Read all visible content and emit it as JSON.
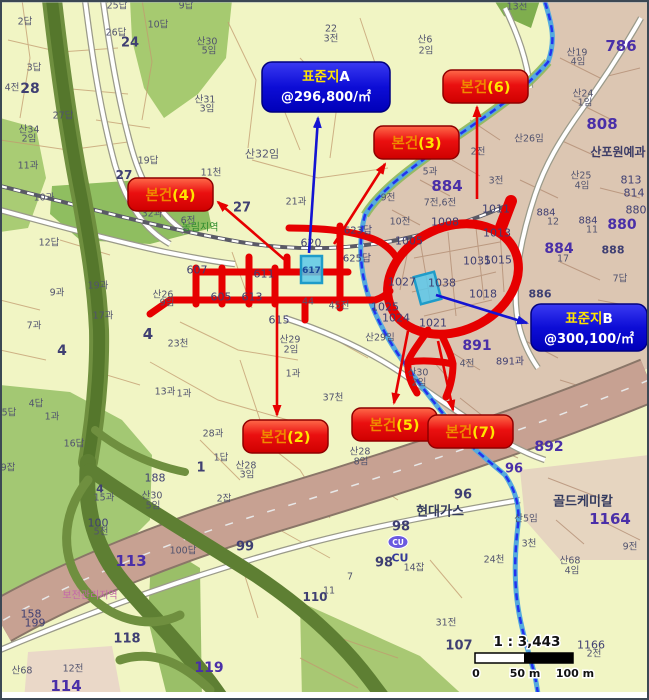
{
  "colors": {
    "accent_red": "#e60000",
    "accent_blue": "#1414d2",
    "cyan_marker": "#49c2ea",
    "map_bg": "#f1f5c4",
    "urban_fill": "#dcc6b2",
    "road_pink": "#c7a192",
    "highway_green": "#5e7f33"
  },
  "map": {
    "labels": [
      {
        "t": "2답",
        "x": 25,
        "y": 22
      },
      {
        "t": "28",
        "x": 30,
        "y": 89,
        "s": 14,
        "b": 1,
        "c": "#3f3f72"
      },
      {
        "t": "4전",
        "x": 12,
        "y": 88
      },
      {
        "t": "3답",
        "x": 34,
        "y": 68
      },
      {
        "t": "27답",
        "x": 63,
        "y": 116
      },
      {
        "t": "산34",
        "x": 29,
        "y": 130
      },
      {
        "t": "2임",
        "x": 29,
        "y": 139
      },
      {
        "t": "11과",
        "x": 28,
        "y": 166
      },
      {
        "t": "25답",
        "x": 117,
        "y": 6
      },
      {
        "t": "26답",
        "x": 116,
        "y": 33
      },
      {
        "t": "24",
        "x": 130,
        "y": 43,
        "s": 13,
        "b": 1,
        "c": "#3f3f72"
      },
      {
        "t": "10답",
        "x": 158,
        "y": 25
      },
      {
        "t": "9답",
        "x": 186,
        "y": 6
      },
      {
        "t": "산30",
        "x": 207,
        "y": 42
      },
      {
        "t": "5임",
        "x": 209,
        "y": 51
      },
      {
        "t": "산31",
        "x": 205,
        "y": 100
      },
      {
        "t": "3임",
        "x": 207,
        "y": 109
      },
      {
        "t": "19답",
        "x": 148,
        "y": 161
      },
      {
        "t": "11천",
        "x": 211,
        "y": 173
      },
      {
        "t": "27",
        "x": 124,
        "y": 175,
        "s": 12,
        "b": 1,
        "c": "#3f3f72"
      },
      {
        "t": "22",
        "x": 331,
        "y": 29
      },
      {
        "t": "3전",
        "x": 331,
        "y": 39
      },
      {
        "t": "산6",
        "x": 425,
        "y": 40
      },
      {
        "t": "2임",
        "x": 426,
        "y": 51
      },
      {
        "t": "13전",
        "x": 517,
        "y": 7
      },
      {
        "t": "산19",
        "x": 577,
        "y": 53
      },
      {
        "t": "4임",
        "x": 578,
        "y": 62
      },
      {
        "t": "786",
        "x": 621,
        "y": 46,
        "s": 15,
        "b": 1,
        "c": "#4a2fa8"
      },
      {
        "t": "산24",
        "x": 583,
        "y": 94
      },
      {
        "t": "1임",
        "x": 585,
        "y": 103
      },
      {
        "t": "808",
        "x": 602,
        "y": 124,
        "s": 15,
        "b": 1,
        "c": "#4a2fa8"
      },
      {
        "t": "산포원예과",
        "x": 618,
        "y": 152,
        "s": 12,
        "b": 1,
        "c": "#3c3c66"
      },
      {
        "t": "산26임",
        "x": 529,
        "y": 139
      },
      {
        "t": "2전",
        "x": 478,
        "y": 152
      },
      {
        "t": "3전",
        "x": 496,
        "y": 181
      },
      {
        "t": "산25",
        "x": 581,
        "y": 176
      },
      {
        "t": "4임",
        "x": 582,
        "y": 186
      },
      {
        "t": "813",
        "x": 631,
        "y": 180,
        "s": 11,
        "c": "#3f3f72"
      },
      {
        "t": "814",
        "x": 634,
        "y": 193,
        "s": 11,
        "c": "#3f3f72"
      },
      {
        "t": "880",
        "x": 636,
        "y": 210,
        "s": 11,
        "c": "#3f3f72"
      },
      {
        "t": "880",
        "x": 622,
        "y": 225,
        "s": 14,
        "b": 1,
        "c": "#4a2fa8"
      },
      {
        "t": "884",
        "x": 546,
        "y": 213,
        "s": 10,
        "c": "#3f3f72"
      },
      {
        "t": "12",
        "x": 553,
        "y": 222
      },
      {
        "t": "884",
        "x": 588,
        "y": 221,
        "s": 10,
        "c": "#3f3f72"
      },
      {
        "t": "11",
        "x": 592,
        "y": 230
      },
      {
        "t": "884",
        "x": 559,
        "y": 249,
        "s": 14,
        "b": 1,
        "c": "#4a2fa8"
      },
      {
        "t": "17",
        "x": 563,
        "y": 259
      },
      {
        "t": "888",
        "x": 613,
        "y": 250,
        "s": 11,
        "b": 1,
        "c": "#3f3f72"
      },
      {
        "t": "886",
        "x": 540,
        "y": 294,
        "s": 11,
        "b": 1,
        "c": "#3f3f72"
      },
      {
        "t": "7답",
        "x": 620,
        "y": 279
      },
      {
        "t": "884",
        "x": 447,
        "y": 186,
        "s": 15,
        "b": 1,
        "c": "#4a2fa8"
      },
      {
        "t": "5과",
        "x": 430,
        "y": 172
      },
      {
        "t": "4임",
        "x": 404,
        "y": 156
      },
      {
        "t": "9전",
        "x": 388,
        "y": 198
      },
      {
        "t": "7전,6전",
        "x": 440,
        "y": 203
      },
      {
        "t": "10전",
        "x": 400,
        "y": 222
      },
      {
        "t": "1008",
        "x": 445,
        "y": 222,
        "s": 11,
        "c": "#3f3f72"
      },
      {
        "t": "1011",
        "x": 496,
        "y": 209,
        "s": 11,
        "c": "#3f3f72"
      },
      {
        "t": "1005",
        "x": 409,
        "y": 241,
        "s": 11,
        "c": "#3f3f72"
      },
      {
        "t": "1013",
        "x": 497,
        "y": 233,
        "s": 11,
        "c": "#3f3f72"
      },
      {
        "t": "1035",
        "x": 477,
        "y": 261,
        "s": 11,
        "c": "#3f3f72"
      },
      {
        "t": "1015",
        "x": 498,
        "y": 260,
        "s": 11,
        "c": "#3f3f72"
      },
      {
        "t": "1027",
        "x": 402,
        "y": 282,
        "s": 11,
        "c": "#3f3f72"
      },
      {
        "t": "1038",
        "x": 442,
        "y": 283,
        "s": 11,
        "c": "#3f3f72"
      },
      {
        "t": "1018",
        "x": 483,
        "y": 294,
        "s": 11,
        "c": "#3f3f72"
      },
      {
        "t": "1025",
        "x": 385,
        "y": 307,
        "s": 11,
        "c": "#3f3f72"
      },
      {
        "t": "1024",
        "x": 396,
        "y": 318,
        "s": 11,
        "c": "#3f3f72"
      },
      {
        "t": "1021",
        "x": 433,
        "y": 323,
        "s": 11,
        "c": "#3f3f72"
      },
      {
        "t": "891",
        "x": 477,
        "y": 346,
        "s": 14,
        "b": 1,
        "c": "#4a2fa8"
      },
      {
        "t": "891과",
        "x": 510,
        "y": 362,
        "s": 10,
        "c": "#3f3f72"
      },
      {
        "t": "4전",
        "x": 467,
        "y": 364
      },
      {
        "t": "산30",
        "x": 418,
        "y": 373
      },
      {
        "t": "2임",
        "x": 419,
        "y": 383
      },
      {
        "t": "산29임",
        "x": 380,
        "y": 338
      },
      {
        "t": "산29",
        "x": 290,
        "y": 340
      },
      {
        "t": "2임",
        "x": 291,
        "y": 350
      },
      {
        "t": "1과",
        "x": 293,
        "y": 374
      },
      {
        "t": "37천",
        "x": 333,
        "y": 398
      },
      {
        "t": "산28",
        "x": 360,
        "y": 452
      },
      {
        "t": "8임",
        "x": 361,
        "y": 462
      },
      {
        "t": "산28",
        "x": 246,
        "y": 466
      },
      {
        "t": "3임",
        "x": 247,
        "y": 475
      },
      {
        "t": "620",
        "x": 311,
        "y": 243,
        "s": 11,
        "c": "#3f3f72"
      },
      {
        "t": "623답",
        "x": 358,
        "y": 231,
        "s": 10,
        "c": "#3f3f72"
      },
      {
        "t": "625답",
        "x": 357,
        "y": 259,
        "s": 10,
        "c": "#3f3f72"
      },
      {
        "t": "607",
        "x": 197,
        "y": 270,
        "s": 11,
        "c": "#3f3f72"
      },
      {
        "t": "611",
        "x": 264,
        "y": 274,
        "s": 11,
        "c": "#3f3f72"
      },
      {
        "t": "605",
        "x": 221,
        "y": 297,
        "s": 11,
        "c": "#3f3f72"
      },
      {
        "t": "613",
        "x": 252,
        "y": 297,
        "s": 11,
        "c": "#3f3f72"
      },
      {
        "t": "44",
        "x": 308,
        "y": 302
      },
      {
        "t": "45전",
        "x": 339,
        "y": 306
      },
      {
        "t": "615",
        "x": 279,
        "y": 320,
        "s": 11,
        "c": "#3f3f72"
      },
      {
        "t": "21과",
        "x": 296,
        "y": 202
      },
      {
        "t": "32과",
        "x": 152,
        "y": 214
      },
      {
        "t": "6전",
        "x": 188,
        "y": 221
      },
      {
        "t": "농림지역",
        "x": 200,
        "y": 228,
        "c": "#2e8b2e",
        "s": 10
      },
      {
        "t": "27",
        "x": 242,
        "y": 208,
        "s": 13,
        "b": 1,
        "c": "#3f3f72"
      },
      {
        "t": "산32임",
        "x": 262,
        "y": 154,
        "s": 11,
        "c": "#565873"
      },
      {
        "t": "10과",
        "x": 44,
        "y": 198
      },
      {
        "t": "12답",
        "x": 49,
        "y": 243
      },
      {
        "t": "9과",
        "x": 57,
        "y": 293
      },
      {
        "t": "7과",
        "x": 34,
        "y": 326
      },
      {
        "t": "4",
        "x": 148,
        "y": 334,
        "s": 15,
        "b": 1,
        "c": "#3f3f72"
      },
      {
        "t": "4",
        "x": 62,
        "y": 351,
        "s": 14,
        "b": 1,
        "c": "#3f3f72"
      },
      {
        "t": "19과",
        "x": 98,
        "y": 286
      },
      {
        "t": "17과",
        "x": 103,
        "y": 316
      },
      {
        "t": "산26",
        "x": 163,
        "y": 295
      },
      {
        "t": "9임",
        "x": 167,
        "y": 303
      },
      {
        "t": "23천",
        "x": 178,
        "y": 344
      },
      {
        "t": "4답",
        "x": 36,
        "y": 404
      },
      {
        "t": "5답",
        "x": 9,
        "y": 413
      },
      {
        "t": "1과",
        "x": 52,
        "y": 417
      },
      {
        "t": "9잡",
        "x": 8,
        "y": 468
      },
      {
        "t": "16답",
        "x": 74,
        "y": 444
      },
      {
        "t": "13과",
        "x": 165,
        "y": 392
      },
      {
        "t": "1과",
        "x": 184,
        "y": 394
      },
      {
        "t": "28과",
        "x": 213,
        "y": 434
      },
      {
        "t": "1답",
        "x": 221,
        "y": 458
      },
      {
        "t": "1",
        "x": 201,
        "y": 468,
        "s": 13,
        "b": 1,
        "c": "#3f3f72"
      },
      {
        "t": "2잡",
        "x": 224,
        "y": 499
      },
      {
        "t": "188",
        "x": 155,
        "y": 478,
        "s": 11,
        "c": "#3f3f72"
      },
      {
        "t": "산30",
        "x": 152,
        "y": 496
      },
      {
        "t": "5임",
        "x": 153,
        "y": 506
      },
      {
        "t": "4",
        "x": 100,
        "y": 489,
        "s": 11,
        "b": 1,
        "c": "#3f3f72"
      },
      {
        "t": "15과",
        "x": 104,
        "y": 498
      },
      {
        "t": "100",
        "x": 98,
        "y": 523,
        "s": 11,
        "c": "#3f3f72"
      },
      {
        "t": "5천",
        "x": 101,
        "y": 532
      },
      {
        "t": "113",
        "x": 131,
        "y": 561,
        "s": 15,
        "b": 1,
        "c": "#4a2fa8"
      },
      {
        "t": "100답",
        "x": 183,
        "y": 551
      },
      {
        "t": "158",
        "x": 31,
        "y": 614,
        "s": 11,
        "c": "#3f3f72"
      },
      {
        "t": "199",
        "x": 35,
        "y": 623,
        "s": 11,
        "c": "#3f3f72"
      },
      {
        "t": "114",
        "x": 66,
        "y": 686,
        "s": 15,
        "b": 1,
        "c": "#4a2fa8"
      },
      {
        "t": "12전",
        "x": 73,
        "y": 669
      },
      {
        "t": "산68",
        "x": 22,
        "y": 671
      },
      {
        "t": "118",
        "x": 127,
        "y": 639,
        "s": 13,
        "b": 1,
        "c": "#3f3f72"
      },
      {
        "t": "119",
        "x": 209,
        "y": 668,
        "s": 14,
        "b": 1,
        "c": "#4a2fa8"
      },
      {
        "t": "보전관리지역",
        "x": 90,
        "y": 596,
        "c": "#c468a8",
        "s": 10
      },
      {
        "t": "현대가스",
        "x": 440,
        "y": 512,
        "s": 13,
        "b": 1,
        "c": "#333a5e"
      },
      {
        "t": "96",
        "x": 463,
        "y": 495,
        "s": 13,
        "b": 1,
        "c": "#3f3f72"
      },
      {
        "t": "96",
        "x": 514,
        "y": 469,
        "s": 13,
        "b": 1,
        "c": "#4a2fa8"
      },
      {
        "t": "98",
        "x": 401,
        "y": 527,
        "s": 13,
        "b": 1,
        "c": "#3f3f72"
      },
      {
        "t": "98",
        "x": 384,
        "y": 563,
        "s": 13,
        "b": 1,
        "c": "#3f3f72"
      },
      {
        "t": "CU",
        "x": 400,
        "y": 558,
        "s": 11,
        "b": 1,
        "c": "#333a99"
      },
      {
        "t": "14잡",
        "x": 414,
        "y": 568
      },
      {
        "t": "7",
        "x": 350,
        "y": 577
      },
      {
        "t": "11",
        "x": 329,
        "y": 591
      },
      {
        "t": "99",
        "x": 245,
        "y": 547,
        "s": 13,
        "b": 1,
        "c": "#3f3f72"
      },
      {
        "t": "110",
        "x": 315,
        "y": 597,
        "s": 12,
        "b": 1,
        "c": "#3f3f72"
      },
      {
        "t": "892",
        "x": 549,
        "y": 447,
        "s": 14,
        "b": 1,
        "c": "#4a2fa8"
      },
      {
        "t": "골드케미칼",
        "x": 583,
        "y": 502,
        "s": 13,
        "b": 1,
        "c": "#333a5e"
      },
      {
        "t": "1164",
        "x": 610,
        "y": 519,
        "s": 15,
        "b": 1,
        "c": "#4a2fa8"
      },
      {
        "t": "9전",
        "x": 630,
        "y": 547
      },
      {
        "t": "3천",
        "x": 529,
        "y": 544
      },
      {
        "t": "24천",
        "x": 494,
        "y": 560
      },
      {
        "t": "산5임",
        "x": 526,
        "y": 519
      },
      {
        "t": "산68",
        "x": 570,
        "y": 561
      },
      {
        "t": "4임",
        "x": 572,
        "y": 571
      },
      {
        "t": "107",
        "x": 459,
        "y": 646,
        "s": 13,
        "b": 1,
        "c": "#3f3f72"
      },
      {
        "t": "31전",
        "x": 446,
        "y": 623
      },
      {
        "t": "1166",
        "x": 591,
        "y": 645,
        "s": 11,
        "c": "#3f3f72"
      },
      {
        "t": "2전",
        "x": 594,
        "y": 654
      }
    ],
    "callouts": {
      "standards": [
        {
          "name": "표준지A",
          "x": 262,
          "y": 62,
          "w": 128,
          "h": 50,
          "line1": [
            {
              "t": "표준지",
              "c": "#ffe400"
            },
            {
              "t": "A",
              "c": "#ffffff"
            }
          ],
          "line2": [
            {
              "t": "@296,800/",
              "c": "#ffffff"
            },
            {
              "t": "㎡",
              "c": "#ffffff"
            }
          ],
          "arrow": {
            "x1": 309,
            "y1": 253,
            "x2": 318,
            "y2": 118
          }
        },
        {
          "name": "표준지B",
          "x": 531,
          "y": 304,
          "w": 116,
          "h": 47,
          "line1": [
            {
              "t": "표준지",
              "c": "#ffe400"
            },
            {
              "t": "B",
              "c": "#ffffff"
            }
          ],
          "line2": [
            {
              "t": "@300,100/",
              "c": "#ffffff"
            },
            {
              "t": "㎡",
              "c": "#ffffff"
            }
          ],
          "arrow": {
            "x1": 436,
            "y1": 295,
            "x2": 527,
            "y2": 323
          }
        }
      ],
      "subjects": [
        {
          "parts": [
            {
              "t": "본건",
              "c": "#f08a00"
            },
            {
              "t": "(2)",
              "c": "#ffe400"
            }
          ],
          "x": 243,
          "y": 420,
          "w": 85,
          "h": 33,
          "arrow": {
            "x1": 277,
            "y1": 303,
            "x2": 277,
            "y2": 415
          }
        },
        {
          "parts": [
            {
              "t": "본건",
              "c": "#f08a00"
            },
            {
              "t": "(3)",
              "c": "#ffe400"
            }
          ],
          "x": 374,
          "y": 126,
          "w": 85,
          "h": 33,
          "arrow": {
            "x1": 334,
            "y1": 244,
            "x2": 385,
            "y2": 164
          }
        },
        {
          "parts": [
            {
              "t": "본건",
              "c": "#f08a00"
            },
            {
              "t": "(4)",
              "c": "#ffe400"
            }
          ],
          "x": 128,
          "y": 178,
          "w": 85,
          "h": 33,
          "arrow": {
            "x1": 285,
            "y1": 260,
            "x2": 218,
            "y2": 202
          }
        },
        {
          "parts": [
            {
              "t": "본건",
              "c": "#f08a00"
            },
            {
              "t": "(5)",
              "c": "#ffe400"
            }
          ],
          "x": 352,
          "y": 408,
          "w": 85,
          "h": 33,
          "arrow": {
            "x1": 408,
            "y1": 331,
            "x2": 394,
            "y2": 403
          }
        },
        {
          "parts": [
            {
              "t": "본건",
              "c": "#f08a00"
            },
            {
              "t": "(6)",
              "c": "#ffe400"
            }
          ],
          "x": 443,
          "y": 70,
          "w": 85,
          "h": 33,
          "arrow": {
            "x1": 477,
            "y1": 199,
            "x2": 477,
            "y2": 107
          }
        },
        {
          "parts": [
            {
              "t": "본건",
              "c": "#f08a00"
            },
            {
              "t": "(7)",
              "c": "#ffe400"
            }
          ],
          "x": 428,
          "y": 415,
          "w": 85,
          "h": 33,
          "arrow": {
            "x1": 438,
            "y1": 341,
            "x2": 453,
            "y2": 410
          }
        }
      ]
    },
    "markers": [
      {
        "label": "617",
        "x": 301,
        "y": 256,
        "w": 21,
        "h": 27,
        "rot": 0,
        "cx": 311.5,
        "cy": 270
      },
      {
        "label": "",
        "x": 417,
        "y": 274,
        "w": 21,
        "h": 28,
        "rot": -15,
        "cx": 427.5,
        "cy": 288
      }
    ],
    "scalebar": {
      "ratio": "1 : 3,443",
      "tick0": "0",
      "tick50": "50 m",
      "tick100": "100 m"
    },
    "logos": {
      "cu": "CU"
    }
  }
}
